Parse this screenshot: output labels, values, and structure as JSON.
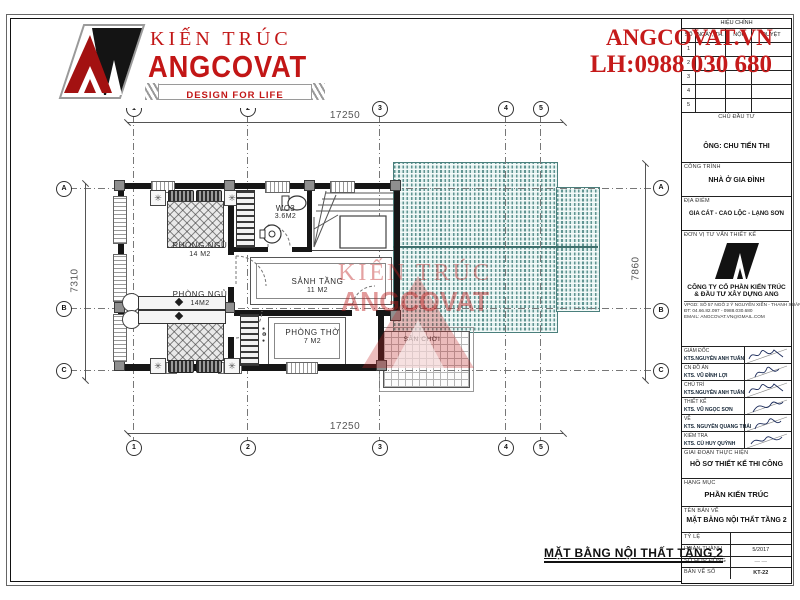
{
  "logo": {
    "brand_top": "KIẾN TRÚC",
    "brand_main": "ANGCOVAT",
    "tagline": "DESIGN FOR LIFE"
  },
  "contact": {
    "website": "ANGCOVAT.VN",
    "phone": "LH:0988 030 680"
  },
  "watermark": {
    "line1": "KIẾN TRÚC",
    "line2": "ANGCOVAT"
  },
  "plan": {
    "caption": "MẶT BẰNG NỘI THẤT TẦNG 2",
    "dims": {
      "top": "17250",
      "bottom": "17250",
      "left": "7310",
      "right": "7860"
    },
    "grid": {
      "cols": [
        "1",
        "2",
        "3",
        "4",
        "5"
      ],
      "rows": [
        "A",
        "B",
        "C"
      ]
    },
    "rooms": {
      "bedroom1": {
        "name": "PHÒNG NGỦ",
        "area": "14 M2"
      },
      "bedroom2": {
        "name": "PHÒNG NGỦ",
        "area": "14M2"
      },
      "wc": {
        "name": "WC3",
        "area": "3.6M2"
      },
      "hall": {
        "name": "SẢNH TẦNG",
        "area": "11 M2"
      },
      "worship": {
        "name": "PHÒNG THỜ",
        "area": "7 M2"
      },
      "playground": {
        "name": "SÂN CHƠI"
      }
    }
  },
  "titleblock": {
    "revisions": {
      "title": "HIỆU CHỈNH",
      "columns": [
        "SỐ",
        "NGÀY, TH.",
        "NỘI DUNG",
        "DUYỆT"
      ],
      "rows": [
        "1",
        "2",
        "3",
        "4",
        "5"
      ]
    },
    "investor_label": "CHỦ ĐẦU TƯ",
    "investor": "ÔNG: CHU TIẾN THI",
    "project_label": "CÔNG TRÌNH",
    "project": "NHÀ Ở GIA ĐÌNH",
    "location_label": "ĐỊA ĐIỂM",
    "location": "GIA CÁT - CAO LỘC - LẠNG SƠN",
    "consultant_label": "ĐƠN VỊ TƯ VẤN THIẾT KẾ",
    "company_line1": "CÔNG TY CỔ PHẦN KIẾN TRÚC",
    "company_line2": "& ĐẦU TƯ XÂY DỰNG ANG",
    "office": "VPGD: SỐ 57 NGÕ 2 Ý NGUYỄN XIỂN - THANH XUÂN - HÀ NỘI",
    "tel": "ĐT: 04.66.82.097 - 0988.030.680",
    "email": "EMAIL: ANGCOVAT.VN@GMAIL.COM",
    "signatures": [
      {
        "role": "GIÁM ĐỐC",
        "name": "KTS.NGUYỄN ANH TUẤN"
      },
      {
        "role": "CN ĐỒ ÁN",
        "name": "KTS. VŨ ĐÌNH LỢI"
      },
      {
        "role": "CHỦ TRÌ",
        "name": "KTS.NGUYỄN ANH TUẤN"
      },
      {
        "role": "THIẾT KẾ",
        "name": "KTS. VŨ NGỌC SƠN"
      },
      {
        "role": "VẼ",
        "name": "KTS. NGUYỄN QUANG THÁI"
      },
      {
        "role": "KIỂM TRA",
        "name": "KTS. CÙ HUY QUỲNH"
      }
    ],
    "stage_label": "GIAI ĐOẠN THỰC HIỆN",
    "stage": "HỒ SƠ THIẾT KẾ THI CÔNG",
    "category_label": "HẠNG MỤC",
    "category": "PHẦN KIẾN TRÚC",
    "drawing_label": "TÊN BẢN VẼ",
    "drawing_name": "MẶT BẰNG NỘI THẤT TẦNG 2",
    "meta": [
      {
        "label": "TỶ LỆ",
        "value": ""
      },
      {
        "label": "HOÀN THÀNH",
        "value": "5/2017"
      },
      {
        "label": "SỐ HỢP ĐỒNG",
        "value": "— —"
      },
      {
        "label": "BẢN VẼ SỐ",
        "value": "KT-22"
      }
    ]
  },
  "colors": {
    "brand_red": "#c51a1a",
    "roof_teal": "#4f8f8c"
  }
}
